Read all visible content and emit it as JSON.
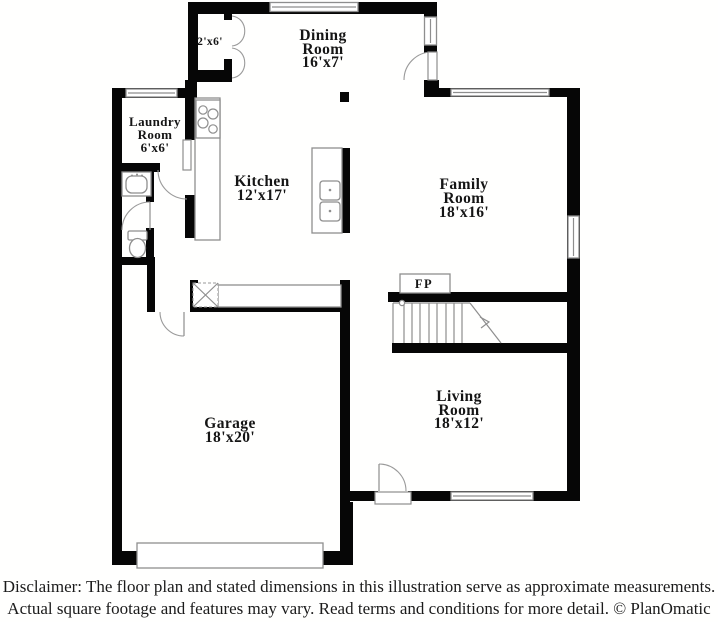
{
  "rooms": {
    "dining": {
      "line1": "Dining",
      "line2": "Room",
      "dims": "16'x7'"
    },
    "kitchen": {
      "line1": "Kitchen",
      "dims": "12'x17'"
    },
    "laundry": {
      "line1": "Laundry",
      "line2": "Room",
      "dims": "6'x6'"
    },
    "family": {
      "line1": "Family",
      "line2": "Room",
      "dims": "18'x16'"
    },
    "garage": {
      "line1": "Garage",
      "dims": "18'x20'"
    },
    "living": {
      "line1": "Living",
      "line2": "Room",
      "dims": "18'x12'"
    },
    "closet": {
      "dims": "2'x6'"
    },
    "fireplace": {
      "label": "FP"
    }
  },
  "fixtures": [
    "stairs",
    "fireplace",
    "garage-door",
    "front-door",
    "side-entry-door",
    "closet-french-doors",
    "laundry-door",
    "powder-door",
    "garage-entry-door",
    "stove",
    "kitchen-double-sink",
    "kitchen-counter",
    "kitchen-island",
    "pantry-closet",
    "bathroom-sink",
    "toilet",
    "window"
  ],
  "disclaimer": {
    "line1": "Disclaimer: The floor plan and stated dimensions in this illustration serve as approximate measurements.",
    "line2": "Actual square footage and features may vary. Read terms and conditions for more detail. © PlanOmatic"
  },
  "colors": {
    "wall": "#060606",
    "fixture_stroke": "#8e8e8e",
    "text": "#151515",
    "background": "#ffffff"
  }
}
